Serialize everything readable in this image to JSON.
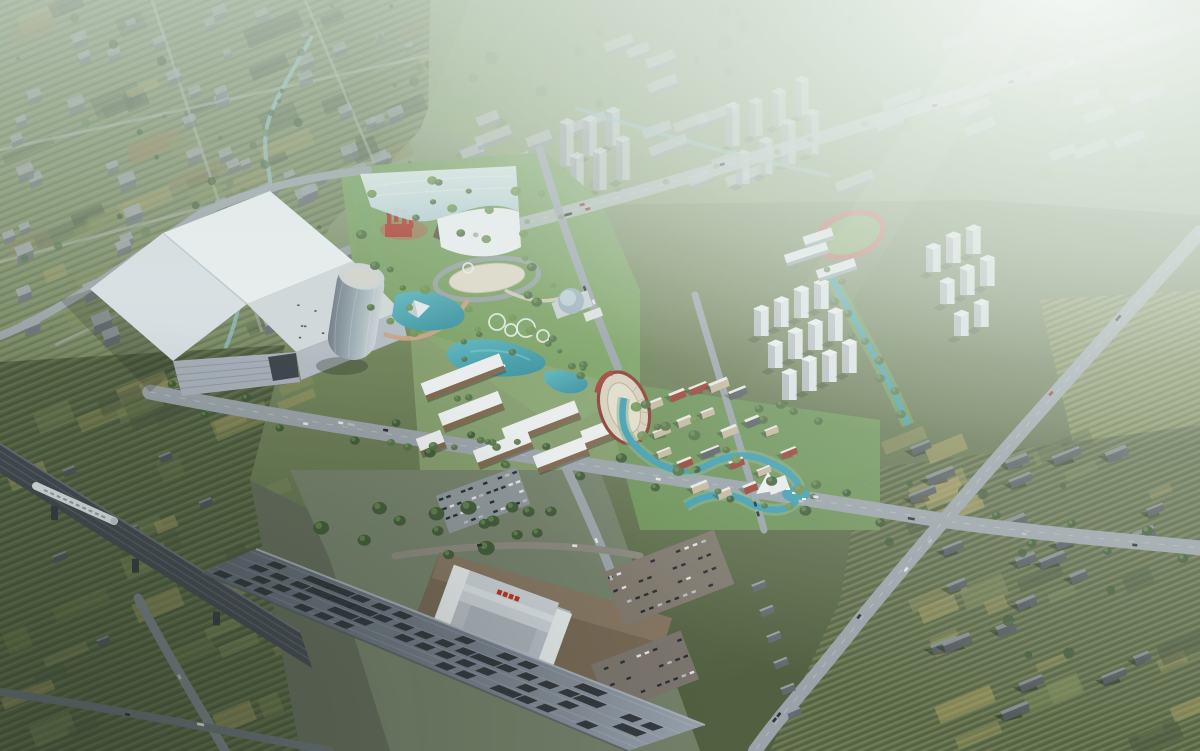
{
  "meta": {
    "image_type": "architectural-aerial-rendering",
    "view": "birds-eye-oblique",
    "atmosphere": "hazy-daylight-sun-glow-top-right"
  },
  "landmarks": [
    {
      "name": "exhibition-hall",
      "desc": "large angular white mega-roof hall"
    },
    {
      "name": "glass-tower",
      "desc": "elliptical glass office tower"
    },
    {
      "name": "theme-park-canopy",
      "desc": "translucent draped glass canopy over rockwork mountain and red castle"
    },
    {
      "name": "central-lake",
      "desc": "kidney-shaped turquoise lake"
    },
    {
      "name": "amphitheater",
      "desc": "oval open-air theater with red rim"
    },
    {
      "name": "cultural-village",
      "desc": "low white buildings with gray and red roofs along winding stream"
    },
    {
      "name": "railway-station",
      "desc": "tiered-roof station with long perforated platform canopy"
    },
    {
      "name": "rail-viaduct",
      "desc": "dark elevated rail bridge with white high-speed train"
    },
    {
      "name": "residential-towers",
      "desc": "white tower clusters east of park"
    },
    {
      "name": "school-running-track",
      "desc": "red oval track with green infield"
    }
  ],
  "station_sign": {
    "color": "#c0271f",
    "glyph_count": 4,
    "readable": false
  },
  "palette": {
    "base_top": "#a9bba0",
    "base_mid": "#75875c",
    "base_bottom": "#4c5a3a",
    "nw_ground": "#76875f",
    "n_ground": "#8ba173",
    "park_green": "#79a05f",
    "lawn": "#8aa470",
    "field_w_base": "#51603f",
    "field_gold": "#a0965c",
    "field_light": "#7d8a55",
    "field_dark": "#42503a",
    "field_brown": "#8a7b50",
    "road_bright": "#b4bbc0",
    "road_mid": "#9aa2a9",
    "road_dark": "#767d85",
    "road_shadow": "#646b73",
    "water_lake_a": "#2b8a9b",
    "water_lake_b": "#58b5c0",
    "water_stream": "#3b9db5",
    "water_canal": "#8fb9c2",
    "block_roof": "#9aa0a5",
    "block_side": "#666c74",
    "slab_roof": "#b6bdc2",
    "slab_side": "#8d949c",
    "tower_front": "#e3e7ea",
    "tower_side": "#b4bac0",
    "tower_roof": "#f4f6f7",
    "hazy_front": "#c3cad0",
    "hazy_side": "#9aa2aa",
    "hall_bright": "#f0f2f5",
    "hall_mid": "#dde2e8",
    "hall_annex": "#d6dade",
    "hall_facade": "#a9b1bb",
    "hall_dark": "#3a4049",
    "glass_dark": "#7d8893",
    "glass_light": "#cfd6da",
    "glass_cap": "#d9d6cf",
    "canopy_glass_a": "#eef5f8",
    "canopy_glass_b": "#c2d8e4",
    "canopy_white": "#f2f4f6",
    "castle_red": "#b03228",
    "castle_dark": "#8a241c",
    "mountain": "#7a6a55",
    "mountain_dark": "#5c4f3e",
    "plaza_beige": "#e5dccb",
    "bridge_tan": "#c9a183",
    "amphi_fill": "#ddd3c0",
    "amphi_inner": "#e8e0cf",
    "amphi_rim": "#8a3328",
    "village_wall": "#f1eee8",
    "roof_dark": "#565b63",
    "roof_red": "#9c3a30",
    "roof_tan": "#c9b9a2",
    "commercial_top": "#f0f1f3",
    "commercial_front": "#7d6148",
    "station_canopy_a": "#555c6a",
    "station_canopy_b": "#737b89",
    "station_canopy_c": "#97a0ad",
    "station_slot": "#23282f",
    "station_apron": "#73624f",
    "station_roof_hi": "#cdd2d8",
    "station_roof_mid": "#b7bdc5",
    "station_parapet": "#e9ecef",
    "station_side": "#8b929c",
    "viaduct": "#3c424b",
    "viaduct_stripe": "#5a616c",
    "train": "#e9edf1",
    "train_win": "#99a1ab",
    "tree_dark": "#3a5431",
    "tree_mid": "#4e6b3f",
    "tree_bright": "#6c8f4e",
    "tree_hazy": "#6f8a5f",
    "car_dark": "#22262b",
    "car_white": "#e8e8e8",
    "car_silver": "#b9bdc1",
    "car_red": "#8a2f28",
    "track_red": "#b5624f",
    "track_green": "#7ba05b",
    "haze": "#d8e6de",
    "glow": "#ffffff",
    "shadow": "#1c2418"
  },
  "counts": {
    "nw_patches": 46,
    "nw_blocks": 88,
    "nw_trees": 58,
    "n_slabs": 30,
    "n_trees": 40,
    "se_patches": 30,
    "se_houses": 24,
    "se_trees": 12,
    "sw_patches": 40,
    "farm_houses": 7,
    "park_trees": 38,
    "lake_trees": 12,
    "village_trees": 22,
    "station_trees": 16,
    "boulevard_tree_step": 38,
    "canal_trees": 10,
    "canopy_slot_rows": 4,
    "ring_sculptures": 5,
    "parking_lots": 3,
    "road_car_total": 36,
    "sheds": 6
  }
}
